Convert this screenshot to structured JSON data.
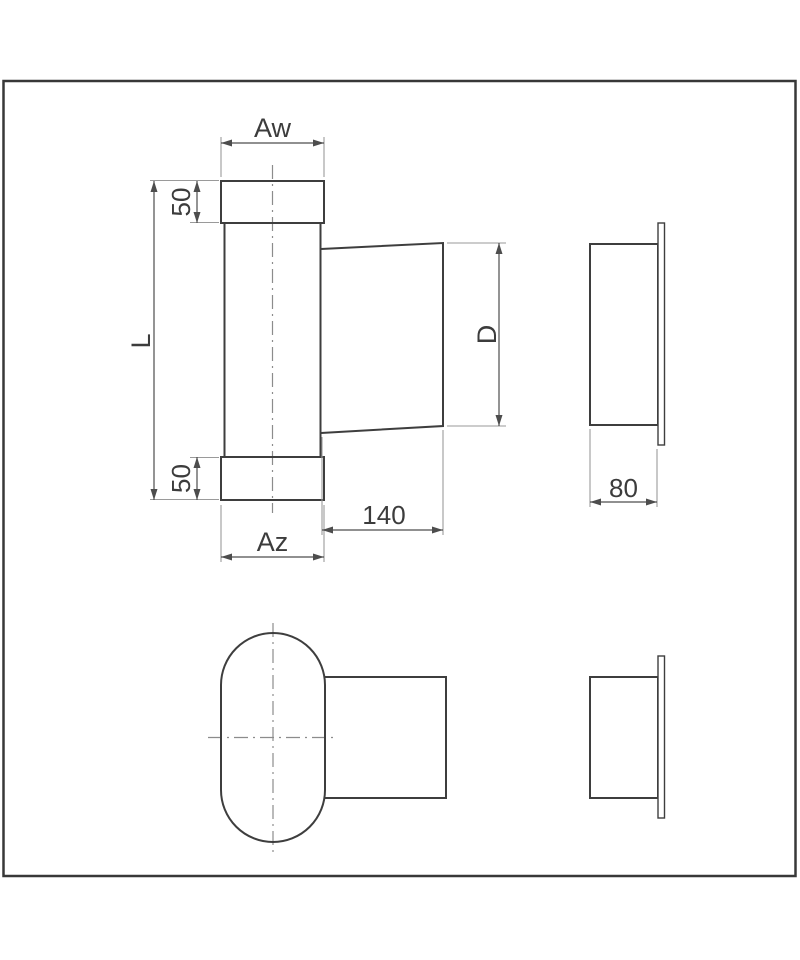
{
  "drawing": {
    "labels": {
      "top_width": "Aw",
      "top_collar_height": "50",
      "length": "L",
      "bottom_collar_height": "50",
      "bottom_width": "Az",
      "branch_length": "140",
      "branch_diameter": "D",
      "flange_depth": "80"
    },
    "colors": {
      "background": "#ffffff",
      "border": "#383838",
      "outline": "#3e3e3e",
      "dimension_line": "#4d4d4d",
      "extension_line": "#9a9a9a",
      "centerline": "#8c8c8c",
      "text": "#3c3c3c"
    }
  }
}
